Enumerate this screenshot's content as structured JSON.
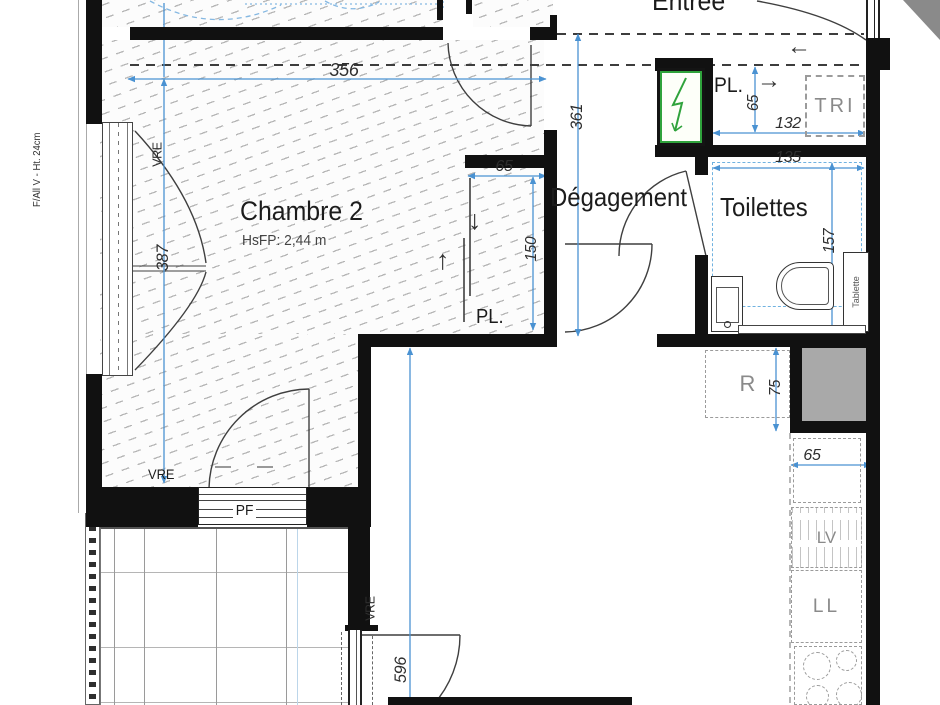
{
  "plan": {
    "rooms": {
      "entree": {
        "label": "Entrée"
      },
      "chambre2": {
        "label": "Chambre 2",
        "ceiling_note": "HsFP: 2,44 m"
      },
      "degagement": {
        "label": "Dégagement"
      },
      "toilettes": {
        "label": "Toilettes"
      }
    },
    "closets": {
      "entree_closet": "PL.",
      "chambre_closet": "PL.",
      "tri": "TRI"
    },
    "openings": {
      "left_window_tag": "VRE",
      "left_window_spec": "F/All V - Ht. 24cm",
      "chambre_door_tag": "VRE",
      "french_window": "PF",
      "sejour_window_tag": "VRE"
    },
    "fixtures": {
      "shelf": "Tablette",
      "fridge": "R",
      "dishwasher": "LV",
      "washing_machine": "LL"
    },
    "dimensions": {
      "chambre_width": "356",
      "chambre_depth": "387",
      "degagement_length": "361",
      "entree_closet_depth": "65",
      "entree_closet_width": "132",
      "toilettes_width": "135",
      "toilettes_depth": "157",
      "chambre_closet_width": "65",
      "chambre_closet_depth": "150",
      "duct_width": "75",
      "counter_depth": "65",
      "sejour_length": "596"
    },
    "icons": {
      "arrow_left": "←",
      "arrow_right": "→",
      "arrow_up": "↑",
      "arrow_down": "↓"
    },
    "colors": {
      "dimension_blue": "#4a92d2",
      "wall_black": "#111111",
      "electrical_green": "#2fa33c",
      "duct_gray": "#a9a9a9",
      "muted_gray": "#8a8a8a",
      "hatch_gray": "#b6b6b6"
    }
  }
}
